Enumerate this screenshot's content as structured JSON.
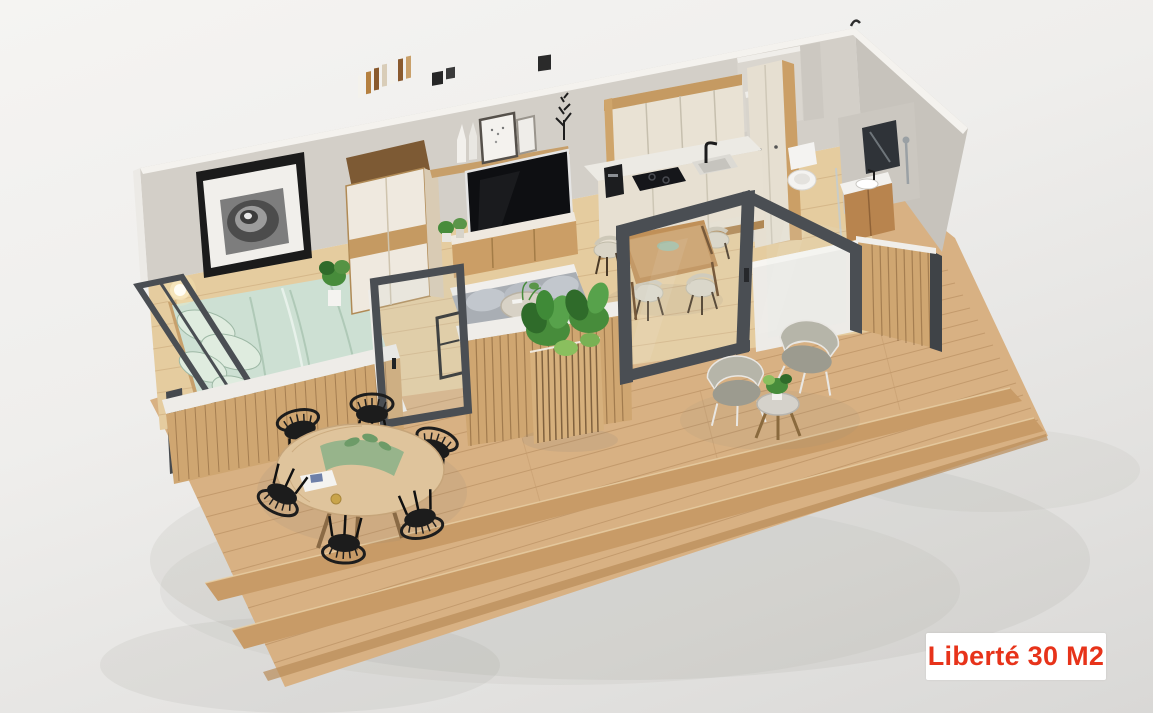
{
  "scene": {
    "type": "3d-isometric-cutaway-render",
    "subject": "Tiny modular home of 30 square meters with large wooden deck terrace, roof removed to show interior layout",
    "rooms": [
      "bedroom",
      "living-room",
      "kitchen",
      "dining-area",
      "bathroom",
      "deck-terrace"
    ],
    "bedroom_items": [
      "double-bed-mint-green-duvet",
      "pillows",
      "framed-spiral-staircase-artwork",
      "wardrobe-with-open-top-shelf",
      "glowing-wall-sconces",
      "potted-plant",
      "corner-window-dark-frame"
    ],
    "living_items": [
      "wall-mounted-tv",
      "wood-shelf-with-picture-frames-and-vases",
      "black-coral-decor",
      "media-console",
      "gray-sofa",
      "round-coffee-table-with-plant",
      "black-side-rack",
      "slatted-half-wall-white-cap"
    ],
    "kitchen_items": [
      "cream-upper-cabinets-wood-trim",
      "tall-cabinet-column",
      "white-countertop",
      "black-induction-cooktop",
      "sink-with-black-faucet",
      "coffee-machine"
    ],
    "dining_items": [
      "rectangular-wood-table",
      "four-shell-chairs"
    ],
    "bathroom_items": [
      "toilet",
      "wood-vanity-with-sink",
      "dark-mirror",
      "shower-fixture"
    ],
    "terrace_items": [
      "round-wood-dining-table",
      "six-black-spindle-chairs",
      "green-table-runner",
      "magazine",
      "slatted-planter-box-with-plants",
      "two-lounge-chairs-gray-cushions",
      "round-side-table-with-plant",
      "two-deck-steps"
    ],
    "architecture": [
      "gray-concrete-walls",
      "dark-framed-glass-sliding-doors",
      "wood-slat-cladding",
      "open-top-cutaway"
    ]
  },
  "label": {
    "text": "Liberté 30 M2"
  },
  "palette": {
    "label-red": "#e7331a",
    "label-bg": "#ffffff",
    "wall": "#d3cfc8",
    "wall-dark": "#c7c3bc",
    "wall-edge": "#f4f2ee",
    "floor-wood": "#e5cc9f",
    "deck-wood": "#d8b183",
    "deck-step": "#c89b67",
    "deck-line": "#aa7f52",
    "slat-wood": "#cfa671",
    "slat-line": "#7c5832",
    "frame-dark": "#4a4e53",
    "bed-mint": "#cde0d3",
    "pillow-mint": "#dfecdf",
    "soft-white": "#f2f1ee",
    "cabinet-cream": "#e9e2d4",
    "wood-mid": "#c59a62",
    "tv-black": "#0e0f12",
    "sofa-gray": "#a9aeb4",
    "chair-black": "#1c1c1c",
    "shell-chair": "#dad5c7",
    "plant-green": "#478c3b",
    "plant-dark": "#2f6b2a"
  }
}
